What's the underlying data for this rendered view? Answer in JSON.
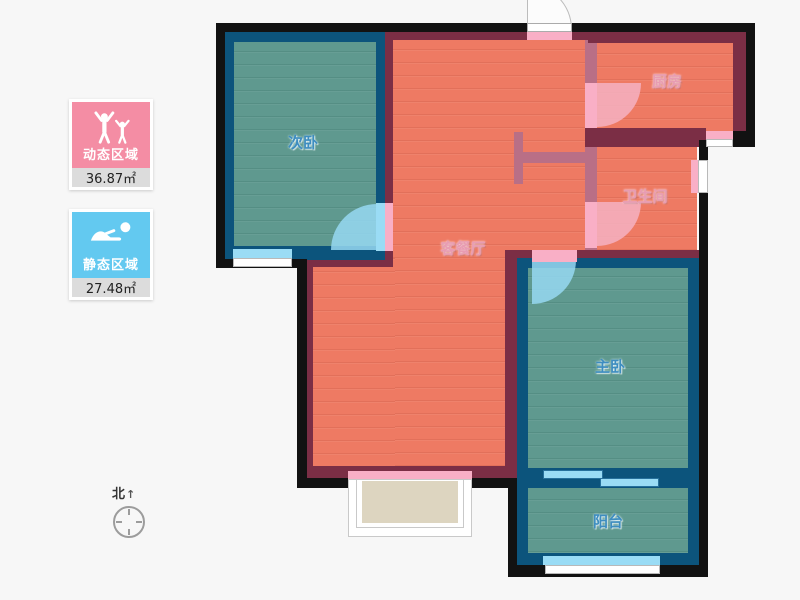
{
  "legend": {
    "dynamic_zone": {
      "label": "动态区域",
      "area": "36.87㎡",
      "color": "#f48da4",
      "icon": "people-cheering-icon"
    },
    "static_zone": {
      "label": "静态区域",
      "area": "27.48㎡",
      "color": "#63c9f0",
      "icon": "sleeping-person-icon"
    }
  },
  "compass": {
    "north_label": "北"
  },
  "floorplan": {
    "rooms": {
      "secondary_bedroom": {
        "label": "次卧",
        "zone": "static"
      },
      "kitchen": {
        "label": "厨房",
        "zone": "dynamic"
      },
      "bathroom": {
        "label": "卫生间",
        "zone": "dynamic"
      },
      "living_dining": {
        "label": "客餐厅",
        "zone": "dynamic"
      },
      "master_bedroom": {
        "label": "主卧",
        "zone": "static"
      },
      "balcony": {
        "label": "阳台",
        "zone": "static"
      }
    },
    "colors": {
      "dynamic_room_fill": "#ee7a63",
      "static_room_fill": "#5f998f",
      "outer_wall": "#121212",
      "dynamic_wall": "#7b2e45",
      "partition_wall": "#b96f86",
      "static_wall": "#0c547c",
      "door_dynamic": "#f9afc6",
      "door_window_static": "#9adcf5",
      "bay_window_fill": "#ddd5c0"
    }
  }
}
